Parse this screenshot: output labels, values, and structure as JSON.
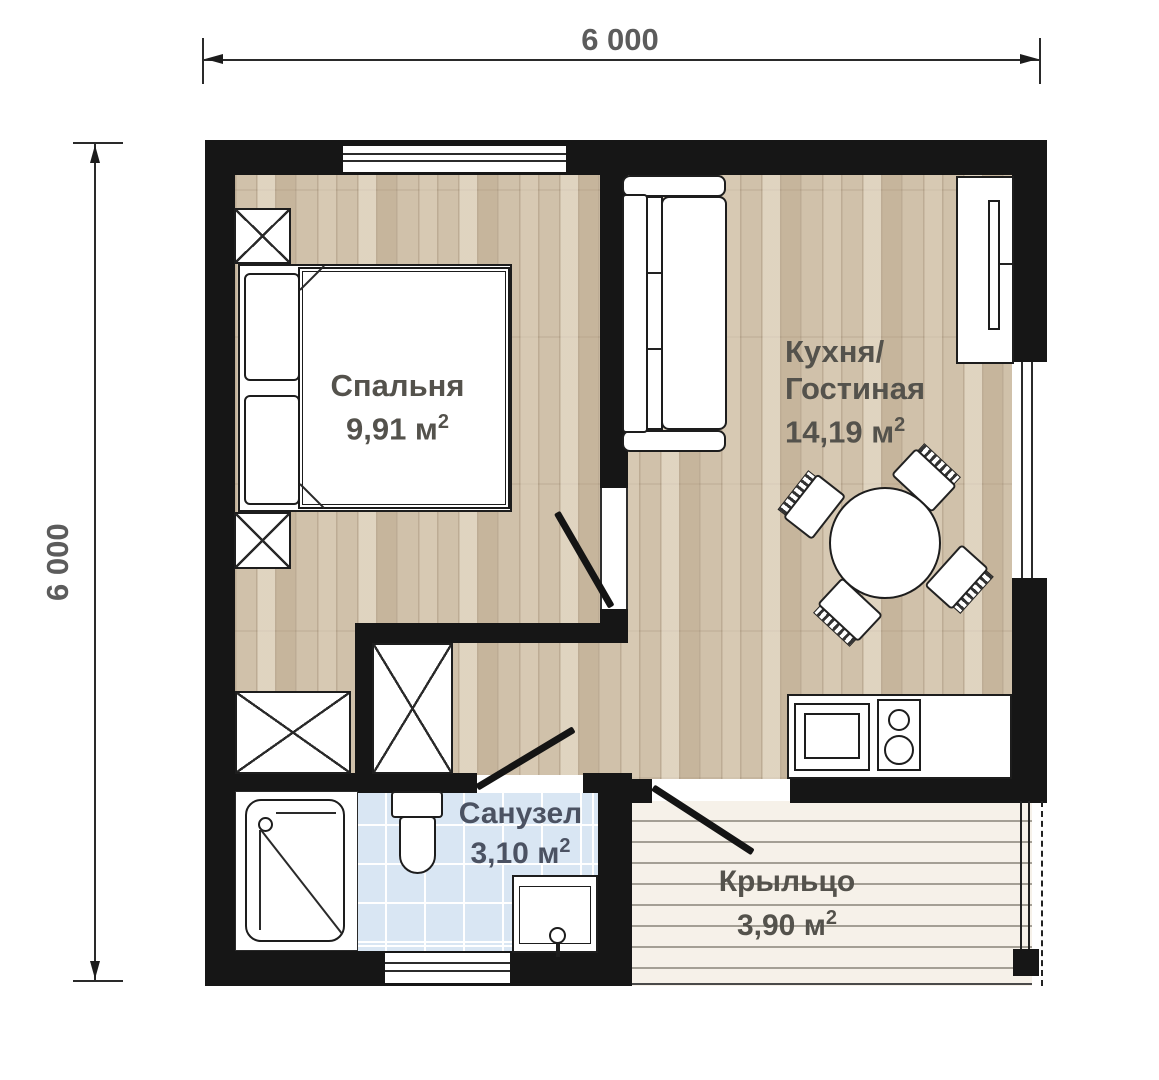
{
  "dimensions": {
    "top": "6 000",
    "left": "6 000"
  },
  "rooms": {
    "bedroom": {
      "name": "Спальня",
      "area": "9,91 м",
      "area_sup": "2"
    },
    "kitchen_living": {
      "name_line1": "Кухня/",
      "name_line2": "Гостиная",
      "area": "14,19 м",
      "area_sup": "2"
    },
    "bathroom": {
      "name": "Санузел",
      "area": "3,10 м",
      "area_sup": "2"
    },
    "porch": {
      "name": "Крыльцо",
      "area": "3,90 м",
      "area_sup": "2"
    }
  },
  "colors": {
    "wall": "#161616",
    "wood_floor": "#d0c1aa",
    "tile_floor": "#d9e6f3",
    "deck": "#f6f1e9",
    "label_text": "#54524c",
    "bathroom_label_text": "#4b5262",
    "dimension_text": "#5c5c5c"
  }
}
